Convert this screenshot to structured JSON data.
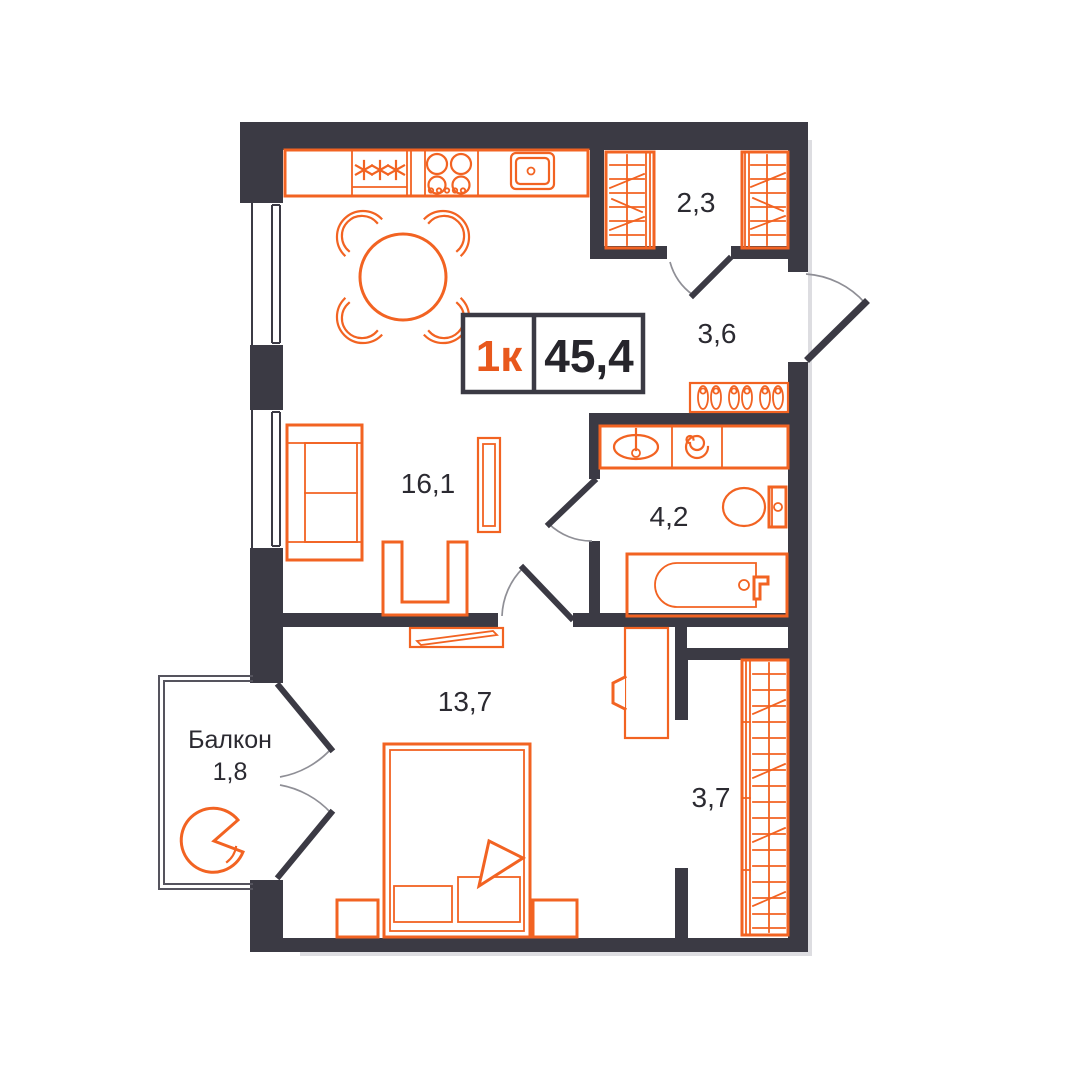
{
  "badge": {
    "type": "1к",
    "area": "45,4"
  },
  "rooms": {
    "wardrobe_top": {
      "area": "2,3"
    },
    "hallway": {
      "area": "3,6"
    },
    "bathroom": {
      "area": "4,2"
    },
    "living_kitchen": {
      "area": "16,1"
    },
    "bedroom": {
      "area": "13,7"
    },
    "wardrobe_corridor": {
      "area": "3,7"
    },
    "balcony": {
      "label": "Балкон",
      "area": "1,8"
    }
  },
  "colors": {
    "wall": "#3B3A44",
    "furniture_outline": "#F26322",
    "badge_accent": "#E8581C",
    "badge_area_text": "#26252B",
    "label_text": "#2B2A31",
    "door_arc": "#8F8F96",
    "balcony_outline": "#55545E",
    "background": "#FFFFFF"
  },
  "icons": [
    "fridge-icon",
    "stove-icon",
    "kitchen-sink-icon",
    "dining-table-icon",
    "chair-icon",
    "sofa-icon",
    "tv-icon",
    "armchair-icon",
    "wall-tv-icon",
    "double-bed-icon",
    "nightstand-icon",
    "desk-icon",
    "desk-chair-icon",
    "wardrobe-icon",
    "shoe-rack-icon",
    "washbasin-icon",
    "washing-machine-icon",
    "toilet-icon",
    "bathtub-icon",
    "balcony-chair-icon",
    "entry-door-icon",
    "interior-door-icon",
    "balcony-door-icon",
    "window-icon"
  ]
}
